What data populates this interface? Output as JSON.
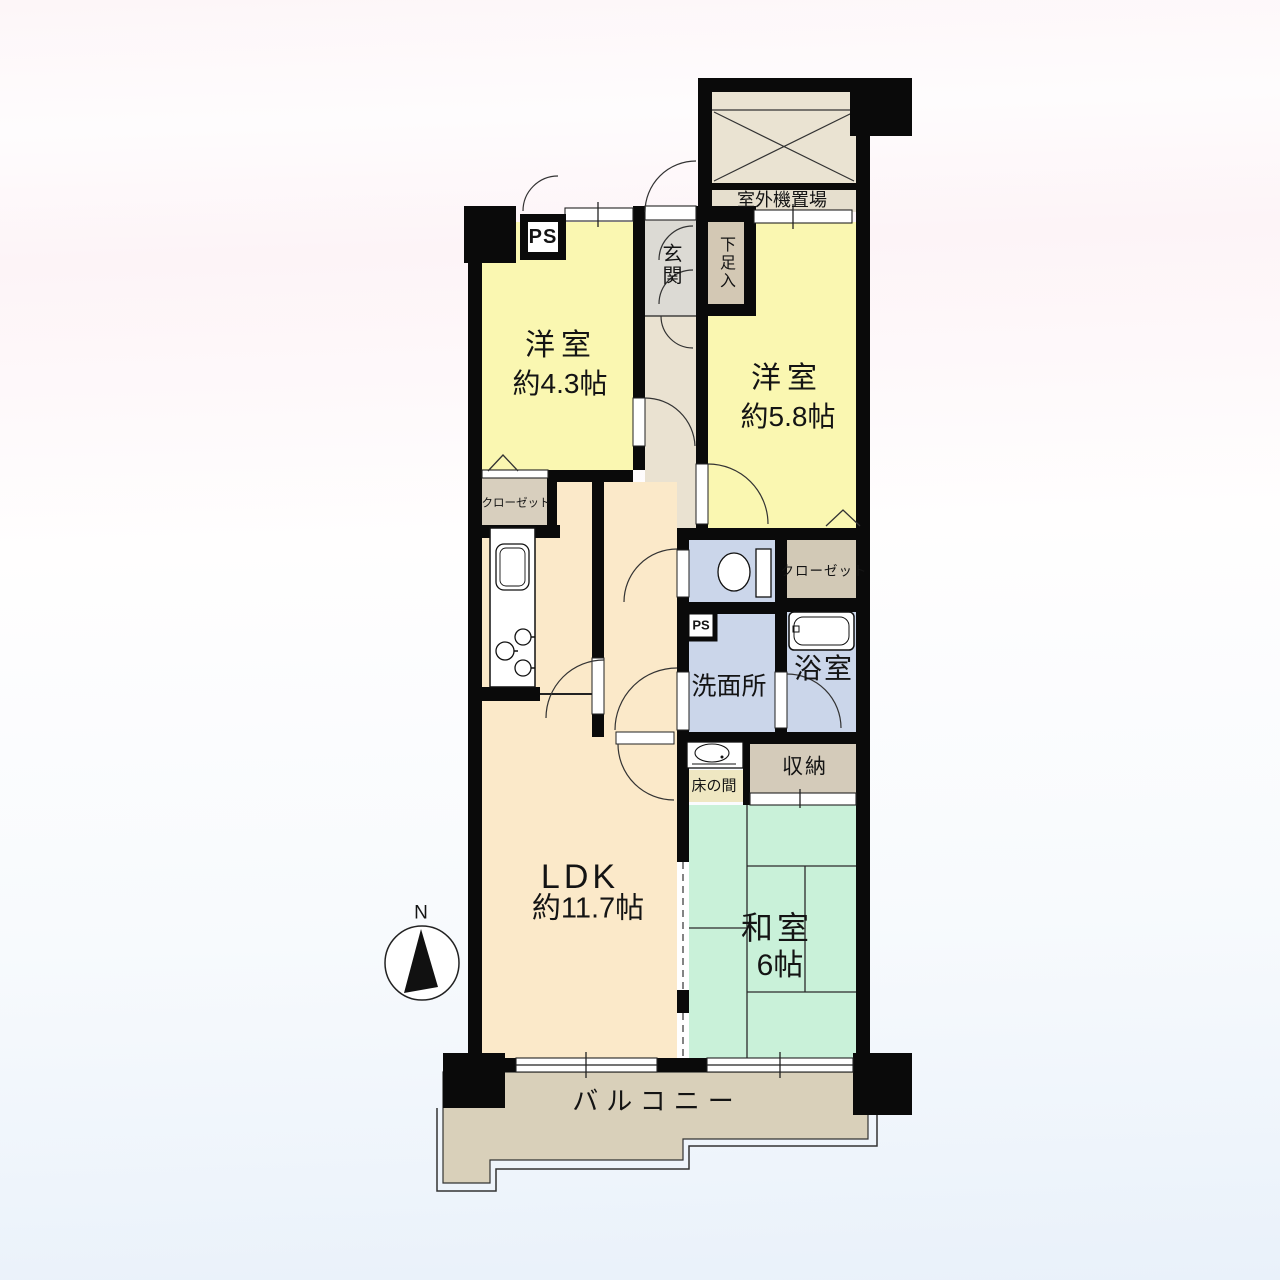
{
  "plan": {
    "title": "2LDK apartment floor plan",
    "labels": {
      "outdoor_unit": "室外機置場",
      "ps_top": "PS",
      "ps_small": "PS",
      "entrance": "玄関",
      "shoe_cabinet": "下足入",
      "western1_name": "洋室",
      "western1_size": "約4.3帖",
      "western2_name": "洋室",
      "western2_size": "約5.8帖",
      "closet_left": "クローゼット",
      "closet_right": "クローゼット",
      "washroom": "洗面所",
      "bathroom": "浴室",
      "tokonoma": "床の間",
      "storage": "収納",
      "ldk_name": "LDK",
      "ldk_size": "約11.7帖",
      "japanese_name": "和室",
      "japanese_size": "6帖",
      "balcony": "バルコニー",
      "compass_north": "N"
    },
    "rooms": [
      {
        "id": "western-room-1",
        "label": "洋室",
        "size": "約4.3帖"
      },
      {
        "id": "western-room-2",
        "label": "洋室",
        "size": "約5.8帖"
      },
      {
        "id": "ldk",
        "label": "LDK",
        "size": "約11.7帖"
      },
      {
        "id": "japanese-room",
        "label": "和室",
        "size": "6帖"
      }
    ],
    "colors": {
      "walls": "#0a0a0a",
      "western_room": "#faf7b1",
      "ldk": "#fbe9c9",
      "japanese_room": "#c9f1d9",
      "wet_area": "#cbd6ea",
      "corridor": "#eae2d1",
      "entrance_floor": "#dcdad4",
      "closet": "#d8cfbe",
      "storage": "#d4cbba",
      "balcony": "#d9d0ba",
      "tokonoma": "#efe7c2",
      "outdoor_unit_area": "#eae3d2"
    }
  }
}
